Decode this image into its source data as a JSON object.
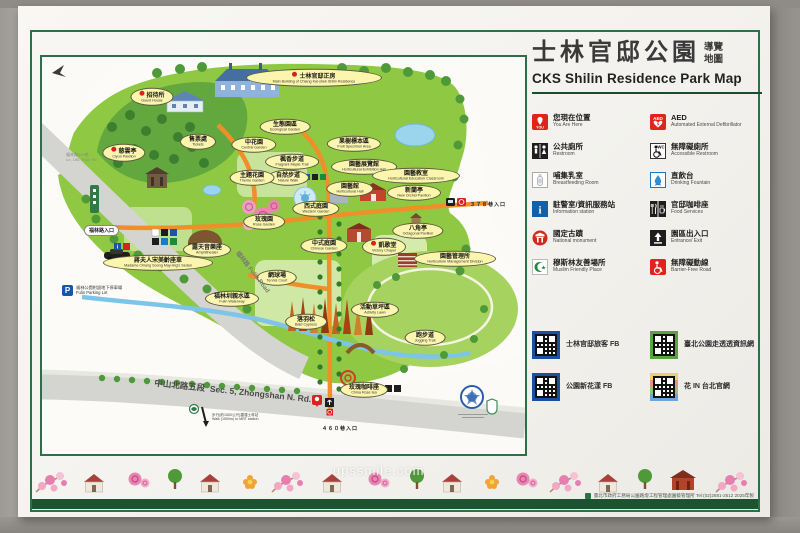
{
  "header": {
    "title_zh": "士林官邸公園",
    "title_small_line1": "導覽",
    "title_small_line2": "地圖",
    "title_en": "CKS Shilin Residence Park Map"
  },
  "legend": {
    "items": [
      {
        "zh": "您現在位置",
        "en": "You Are Here",
        "icon": "you-are-here"
      },
      {
        "zh": "公共廁所",
        "en": "Restroom",
        "icon": "restroom"
      },
      {
        "zh": "哺集乳室",
        "en": "Breastfeeding Room",
        "icon": "breastfeeding"
      },
      {
        "zh": "駐警室/資訊服務站",
        "en": "Information station",
        "icon": "information"
      },
      {
        "zh": "國定古蹟",
        "en": "National monument",
        "icon": "national-monument"
      },
      {
        "zh": "穆斯林友善場所",
        "en": "Muslim Friendly Place",
        "icon": "muslim-friendly"
      },
      {
        "zh": "AED",
        "en": "Automated External Defibrillator",
        "icon": "aed"
      },
      {
        "zh": "無障礙廁所",
        "en": "Accessible Restroom",
        "icon": "accessible-restroom"
      },
      {
        "zh": "直飲台",
        "en": "Drinking Fountain",
        "icon": "drinking-fountain"
      },
      {
        "zh": "官邸咖啡座",
        "en": "Food  Services",
        "icon": "food-services"
      },
      {
        "zh": "園區出入口",
        "en": "Entrance/ Exit",
        "icon": "entrance-exit"
      },
      {
        "zh": "無障礙動線",
        "en": "Barrier-Free Road",
        "icon": "barrier-free"
      }
    ]
  },
  "qr": {
    "items": [
      {
        "label": "士林官邸旅客 FB",
        "style": "blue"
      },
      {
        "label": "臺北公園走透透資訊網",
        "style": "green"
      },
      {
        "label": "公園新花漾 FB",
        "style": "blue"
      },
      {
        "label": "花 IN 台北官網",
        "style": "multi"
      }
    ]
  },
  "map": {
    "labels": [
      {
        "zh": "招待所",
        "en": "Guest House",
        "x": 110,
        "y": 40,
        "m": true
      },
      {
        "zh": "士林官邸正房",
        "en": "Main Building of Chiang Kai-shek Shilin Residence",
        "x": 272,
        "y": 21,
        "m": true,
        "w": 118
      },
      {
        "zh": "慈雲亭",
        "en": "Ciyun Pavilion",
        "x": 82,
        "y": 96,
        "m": true
      },
      {
        "zh": "售票處",
        "en": "Tickets",
        "x": 156,
        "y": 85
      },
      {
        "zh": "中花園",
        "en": "Central Garden",
        "x": 212,
        "y": 88
      },
      {
        "zh": "生態園區",
        "en": "Ecological Garden",
        "x": 243,
        "y": 70
      },
      {
        "zh": "果樹標本區",
        "en": "Fruit Specimen Area",
        "x": 312,
        "y": 87
      },
      {
        "zh": "園藝展覽館",
        "en": "Horticultural Exhibition Hall",
        "x": 322,
        "y": 110
      },
      {
        "zh": "園藝教室",
        "en": "Horticultural Education Classroom",
        "x": 374,
        "y": 119,
        "w": 70
      },
      {
        "zh": "楓香步道",
        "en": "Fragrant Maple Trail",
        "x": 250,
        "y": 105
      },
      {
        "zh": "自然步道",
        "en": "Nature Walk",
        "x": 246,
        "y": 121
      },
      {
        "zh": "主題花園",
        "en": "Theme Garden",
        "x": 210,
        "y": 121
      },
      {
        "zh": "園藝館",
        "en": "Horticultural Hall",
        "x": 308,
        "y": 132
      },
      {
        "zh": "新蘭亭",
        "en": "New Orchid Pavilion",
        "x": 372,
        "y": 136
      },
      {
        "zh": "八角亭",
        "en": "Octagonal Pavilion",
        "x": 376,
        "y": 174
      },
      {
        "zh": "凱歌堂",
        "en": "Victory Chapel",
        "x": 342,
        "y": 190,
        "m": true
      },
      {
        "zh": "園藝管理所",
        "en": "Horticulture Management Division",
        "x": 413,
        "y": 202,
        "w": 64
      },
      {
        "zh": "西式庭園",
        "en": "Western Garden",
        "x": 274,
        "y": 152
      },
      {
        "zh": "玫瑰園",
        "en": "Rose Garden",
        "x": 222,
        "y": 165
      },
      {
        "zh": "中式庭園",
        "en": "Chinese Garden",
        "x": 282,
        "y": 189
      },
      {
        "zh": "露天音樂座",
        "en": "Amphitheater",
        "x": 165,
        "y": 193
      },
      {
        "zh": "網球場",
        "en": "Tennis Court",
        "x": 235,
        "y": 221
      },
      {
        "zh": "蔣夫人宋美齡座車",
        "en": "Madame Chiang Soong May-ling's Sedan",
        "x": 116,
        "y": 206,
        "w": 92
      },
      {
        "zh": "福林圳親水區",
        "en": "Fulin Waterway",
        "x": 190,
        "y": 242
      },
      {
        "zh": "落羽松",
        "en": "Bald Cypress",
        "x": 264,
        "y": 265
      },
      {
        "zh": "活動草坪區",
        "en": "Activity Lawn",
        "x": 333,
        "y": 253
      },
      {
        "zh": "跑步道",
        "en": "Jogging Trail",
        "x": 383,
        "y": 281
      },
      {
        "zh": "玫瑰咖啡座",
        "en": "China Rose tea",
        "x": 322,
        "y": 333
      }
    ],
    "entrances": {
      "lane378": "３７８巷入口",
      "lane460": "４６０巷入口",
      "fulin": "福林路入口"
    },
    "roads": {
      "fulin_zh": "福林路",
      "fulin_en": "Fulin Road",
      "zhongshan_zh": "中山北路五段",
      "zhongshan_en": "Sec. 5, Zhongshan  N. Rd.",
      "lane190_zh": "福林路190巷",
      "lane190_en": "Ln. 190, Fulin Rd."
    },
    "parking": {
      "zh": "福林公園附設地下停車場",
      "en": "Fulin Parking Lot"
    },
    "mrt": {
      "zh": "步行(約1500公尺)捷運士林站",
      "en": "Walk (1500m) to MRT station"
    }
  },
  "photo": {
    "watermark": "upssmile.com"
  },
  "footer": {
    "agency": "臺北市政府工務局公園路燈工程管理處園藝管理所 Tel:(02)2881-2512  2025年製"
  }
}
